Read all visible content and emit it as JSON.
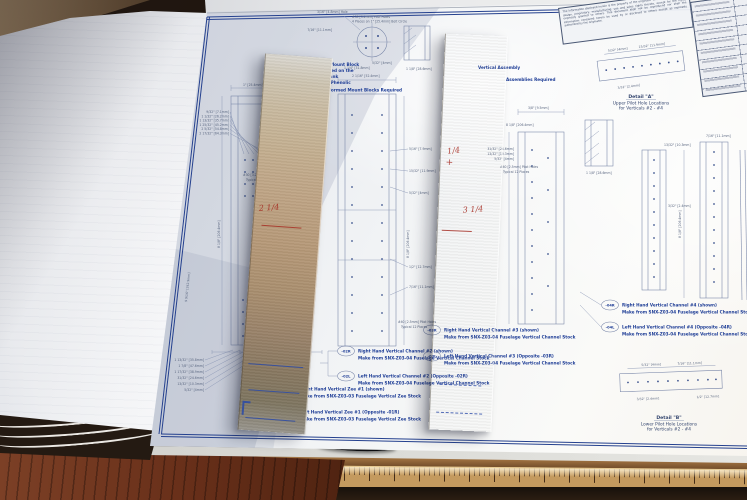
{
  "drawing": {
    "disclaimer": "The information disclosed herein is the property of the originator who reserves all patent, design, proprietary, manufacturing, use and sales rights thereto, except for the rights expressly granted to others. This document shall not be reproduced nor shall the information contained herein be used by or disclosed to others except as expressly authorized by the originator.",
    "details": {
      "a": {
        "title": "Detail \"A\"",
        "line1": "Upper Pilot Hole Locations",
        "line2": "for Verticals #2 - #4"
      },
      "b": {
        "title": "Detail \"B\"",
        "line1": "Lower Pilot Hole Locations",
        "line2": "for Verticals #2 - #4"
      }
    },
    "parts": [
      {
        "tag": "-02R",
        "line1": "Right Hand Vertical Channel #2  (shown)",
        "line2": "Make from SNX-Z03-04 Fuselage Vertical Channel Stock"
      },
      {
        "tag": "-02L",
        "line1": "Left Hand Vertical Channel #2  (Opposite -02R)",
        "line2": "Make from SNX-Z03-04 Fuselage Vertical Channel Stock"
      },
      {
        "tag": "-01R",
        "line1": "Right Hand Vertical Zee #1  (shown)",
        "line2": "Make from SNX-Z03-03 Fuselage Vertical Zee Stock"
      },
      {
        "tag": "-01L",
        "line1": "Left Hand Vertical Zee #1  (Opposite -01R)",
        "line2": "Make from SNX-Z03-03 Fuselage Vertical Zee Stock"
      },
      {
        "tag": "-03R",
        "line1": "Right Hand Vertical Channel #3  (shown)",
        "line2": "Make from SNX-Z03-04 Fuselage Vertical Channel Stock"
      },
      {
        "tag": "-03L",
        "line1": "Left Hand Vertical Channel #3  (Opposite -03R)",
        "line2": "Make from SNX-Z03-04 Fuselage Vertical Channel Stock"
      },
      {
        "tag": "-04R",
        "line1": "Right Hand Vertical Channel #4  (shown)",
        "line2": "Make from SNX-Z03-04 Fuselage Vertical Channel Stock"
      },
      {
        "tag": "-04L",
        "line1": "Left Hand Vertical Channel #4  (Opposite -04R)",
        "line2": "Make from SNX-Z03-04 Fuselage Vertical Channel Stock"
      }
    ],
    "notes": {
      "assembly1": "Vertical Assembly",
      "assembly2": "Assemblies Required",
      "mount1": "Front Mount Block",
      "mount2": "attached on the",
      "mount3": "Fuel Tank",
      "mount4": "Blank Phenolic",
      "mount5": "(4) Formed Mount Blocks Required",
      "pilot_a": "#30 [3.2mm] Pilot Holes",
      "pilot_a2": "Typical 4 Places",
      "pilot_b": "#40 [2.5mm] Pilot Holes",
      "pilot_b2": "Typical 12 Places",
      "bolt_circle": "4 Places on 1\" [25.4mm] Bolt Circle",
      "hole": "3/16\" [4.8mm] Hole"
    },
    "dims": [
      "9/32\" [7.1mm]",
      "1 1/32\" [26.2mm]",
      "1 13/32\" [35.7mm]",
      "1 25/32\" [45.2mm]",
      "2 5/32\" [54.8mm]",
      "2 17/32\" [64.3mm]",
      "1 13/32\" [35.8mm]",
      "1 7/8\" [47.6mm]",
      "1 17/32\" [38.9mm]",
      "31/32\" [24.6mm]",
      "13/32\" [10.3mm]",
      "5/32\" [4mm]",
      "8 1/8\" [206.4mm]",
      "9 9/16\" [242.9mm]",
      "1 1/8\" [28.6mm]",
      "1/2\" [12.7mm]",
      "1 1/4\" [31.8mm]",
      "5/16\" [7.9mm]",
      "15/32\" [11.9mm]",
      "1\" [25.4mm]",
      "2 1/16\" [52.4mm]",
      "3/8\" [9.5mm]",
      "7/16\" [11.1mm]",
      "3/32\" [2.4mm]"
    ]
  },
  "strips": {
    "left_mark": "2 1/4",
    "right_mark_top": "1/4",
    "right_mark_plus": "+",
    "right_mark_bottom": "3 1/4"
  }
}
